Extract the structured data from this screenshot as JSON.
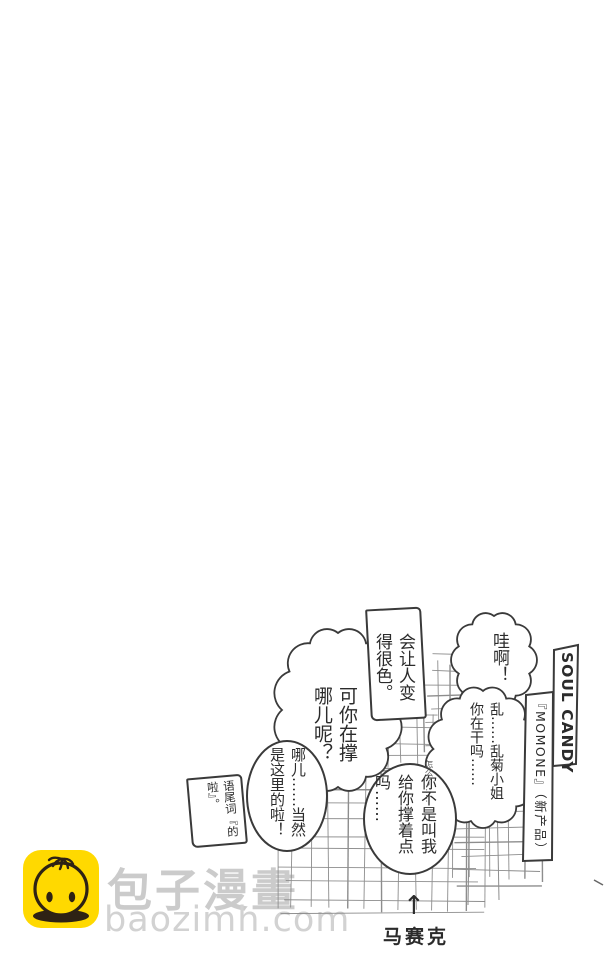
{
  "bubbles": {
    "wah": "哇啊！",
    "lewd": "会让人变\n得很色。",
    "rangiku": "乱……乱菊小姐\n你在干吗……",
    "prop_where": "可你在撑\n哪儿呢？",
    "here": "哪儿……当然\n是这里的啦！",
    "tail_word": "语尾词『的\n啦』。",
    "hold_up": "你不是叫我\n给你撑着点\n吗……",
    "note": "怎么了……"
  },
  "product_box": {
    "title": "SOUL CANDY",
    "subtitle": "『MOMONE』（新产品）"
  },
  "mosaic": {
    "arrow": "↑",
    "label": "马赛克"
  },
  "watermark": {
    "site_name": "包子漫畫",
    "site_url": "baozimh.com"
  },
  "colors": {
    "ink": "#3a3a3a",
    "pencil": "#8d8d8d",
    "watermark_gray": "#cbcbcb",
    "icon_yellow": "#ffd900"
  }
}
